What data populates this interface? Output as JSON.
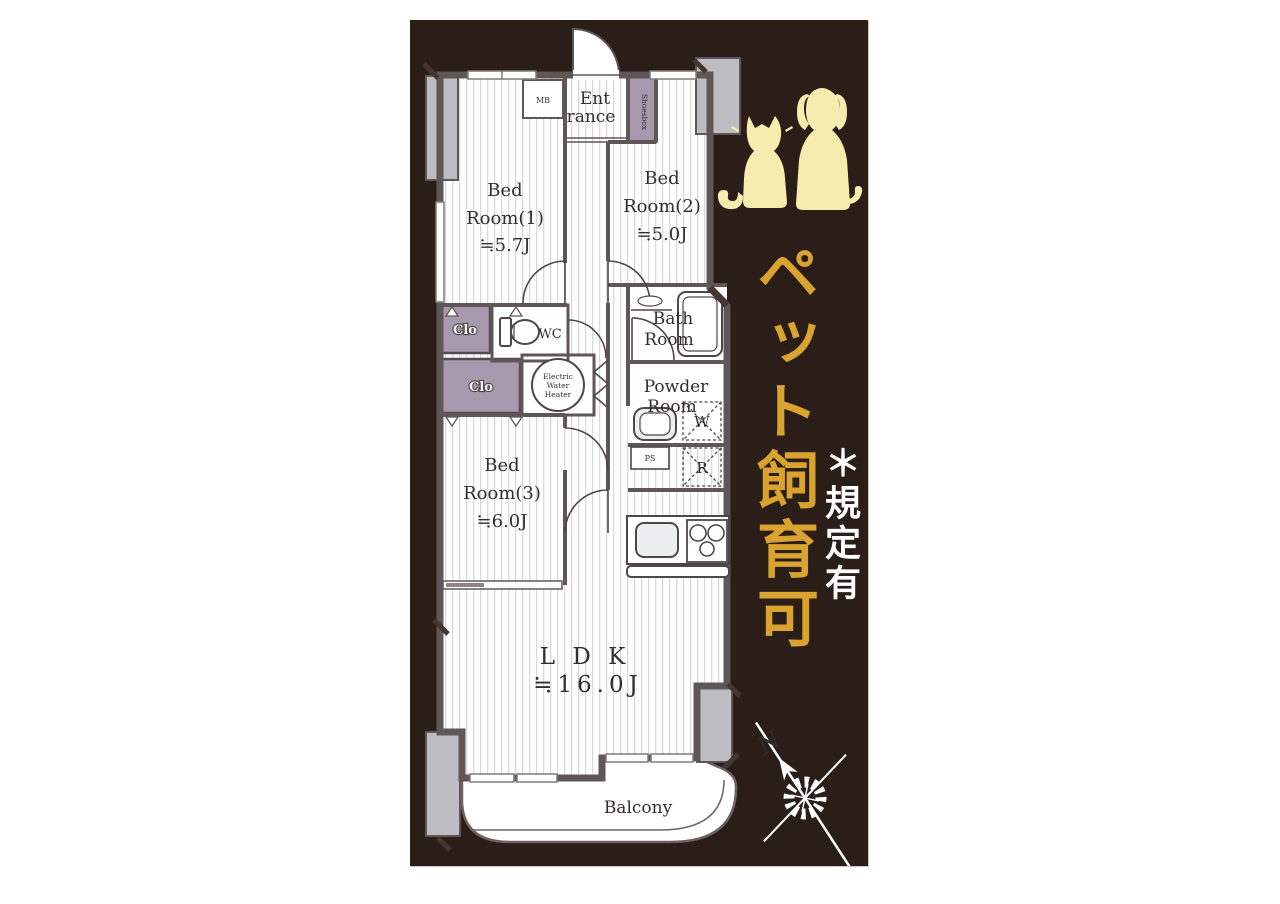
{
  "side_panel": {
    "pet_text": "ペット飼育可",
    "note_text": "＊規定有",
    "colors": {
      "background": "#2b1e18",
      "gold": "#d8a32e",
      "cream": "#f6ecae",
      "white": "#ffffff"
    }
  },
  "floorplan": {
    "colors": {
      "wall": "#5f5757",
      "closet_purple": "#a699ae",
      "pillar_gray": "#bdbcc1",
      "floor_stripe": "#d9dae0"
    },
    "rooms": {
      "bedroom1": {
        "name1": "Bed",
        "name2": "Room(1)",
        "size": "≒5.7J"
      },
      "bedroom2": {
        "name1": "Bed",
        "name2": "Room(2)",
        "size": "≒5.0J"
      },
      "bedroom3": {
        "name1": "Bed",
        "name2": "Room(3)",
        "size": "≒6.0J"
      },
      "ldk": {
        "name": "L D K",
        "size": "≒16.0J"
      },
      "entrance": {
        "name1": "Ent",
        "name2": "rance"
      },
      "bath": {
        "name1": "Bath",
        "name2": "Room"
      },
      "powder": {
        "name1": "Powder",
        "name2": "Room"
      },
      "balcony": {
        "name": "Balcony"
      }
    },
    "fixtures": {
      "mb": "MB",
      "shoesbox": "Shoesbox",
      "wc": "WC",
      "closet1": "Clo",
      "closet2": "Clo",
      "water_heater": {
        "line1": "Electric",
        "line2": "Water",
        "line3": "Heater"
      },
      "ps": "PS",
      "washer": "W",
      "refrigerator": "R"
    },
    "compass": {
      "north": "N"
    }
  }
}
